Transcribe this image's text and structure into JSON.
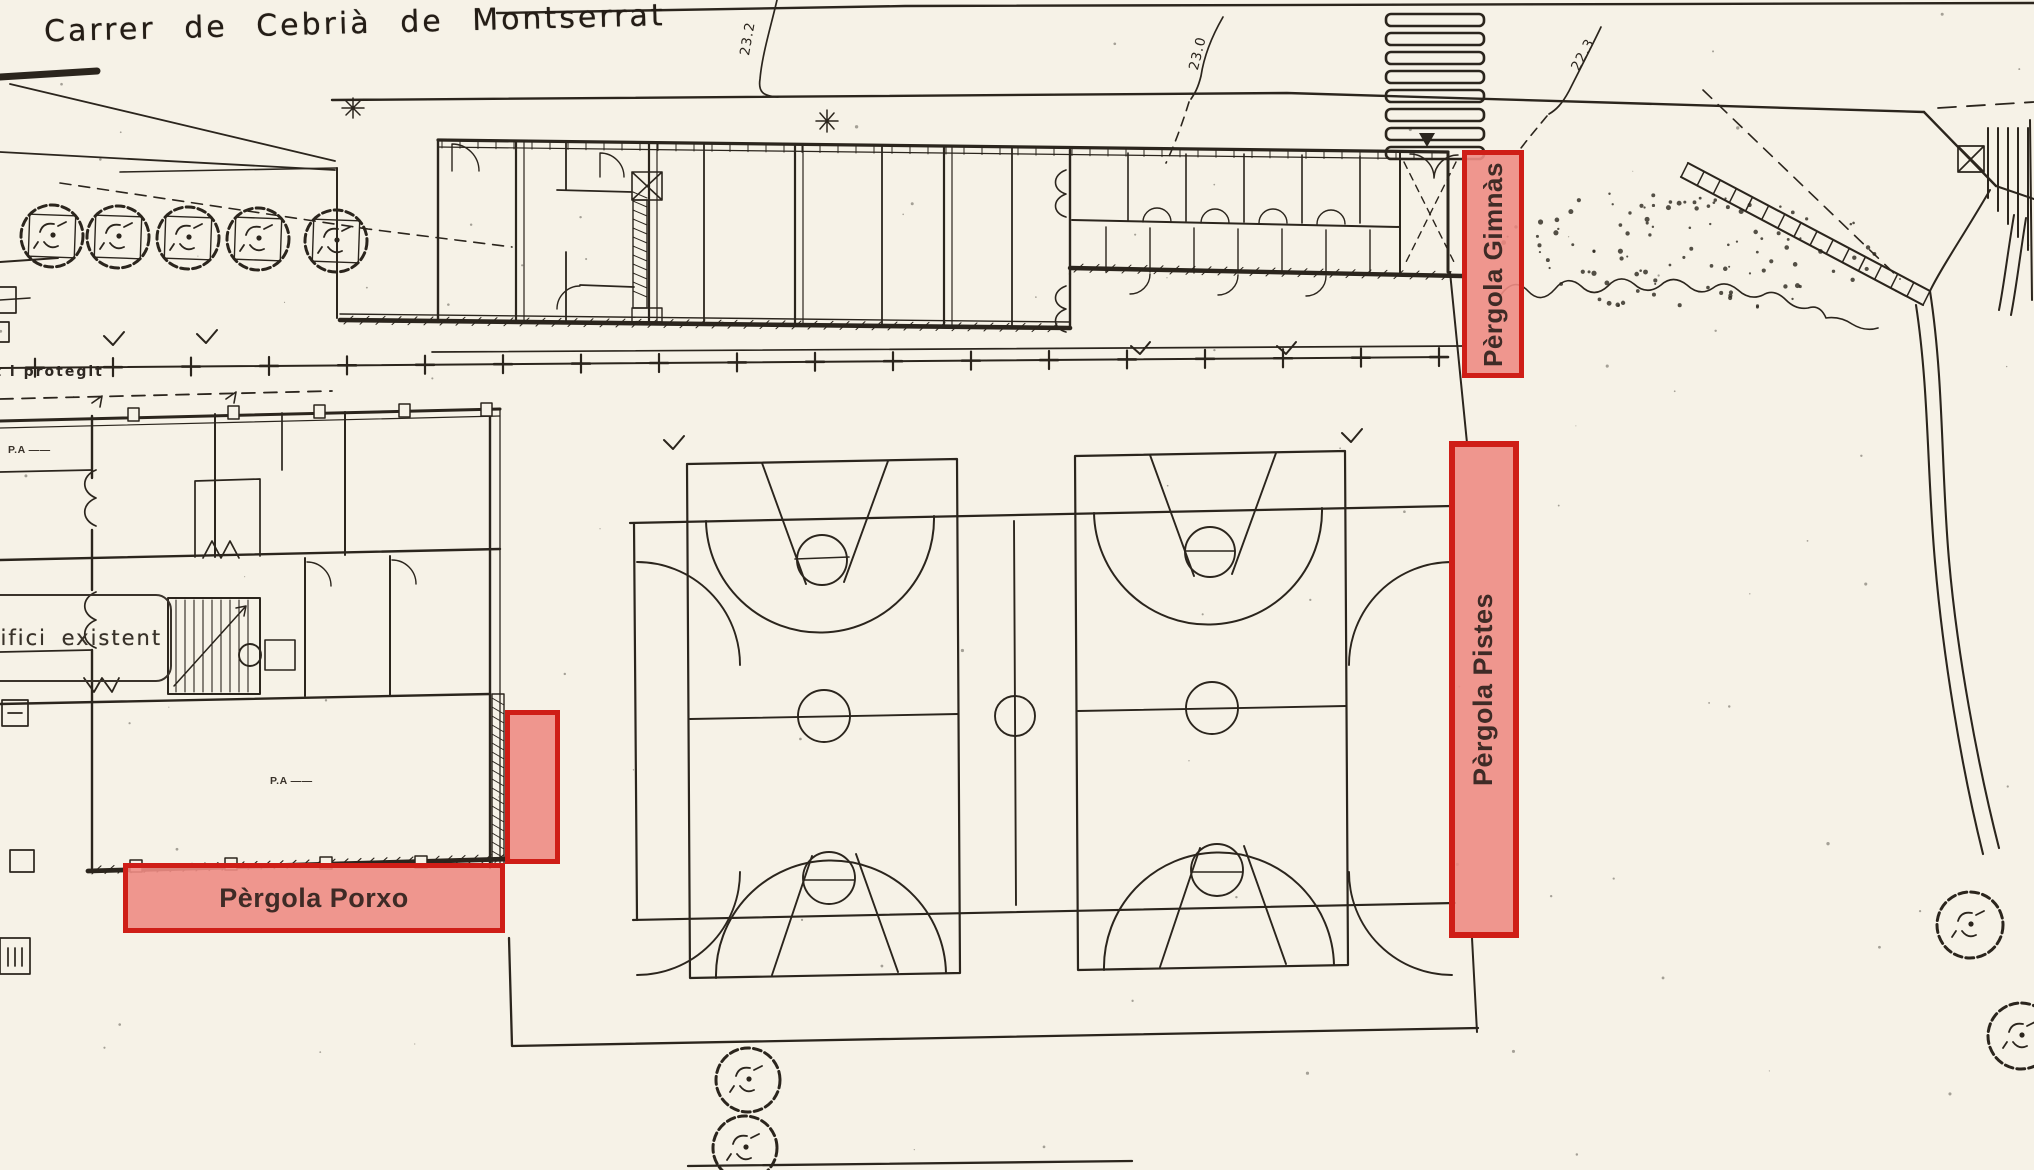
{
  "plan": {
    "street_name": "Carrer de Cebrià de Montserrat",
    "existing_building_label": "Edifici existent",
    "edge_note": "rat i protegit",
    "pa_note_upper": "P.A ——",
    "pa_note_lower": "P.A ——",
    "contour_labels": {
      "left": "23.2",
      "middle": "23.0",
      "right": "22.3"
    },
    "highlights": {
      "gimnas_label": "Pèrgola Gimnàs",
      "pistes_label": "Pèrgola Pistes",
      "porxo_label": "Pèrgola Porxo"
    },
    "colors": {
      "paper": "#f6f2e7",
      "ink": "#2b251d",
      "highlight_border": "#cf1e17",
      "highlight_fill": "#ee8c84",
      "highlight_text": "#3f2b26"
    }
  }
}
